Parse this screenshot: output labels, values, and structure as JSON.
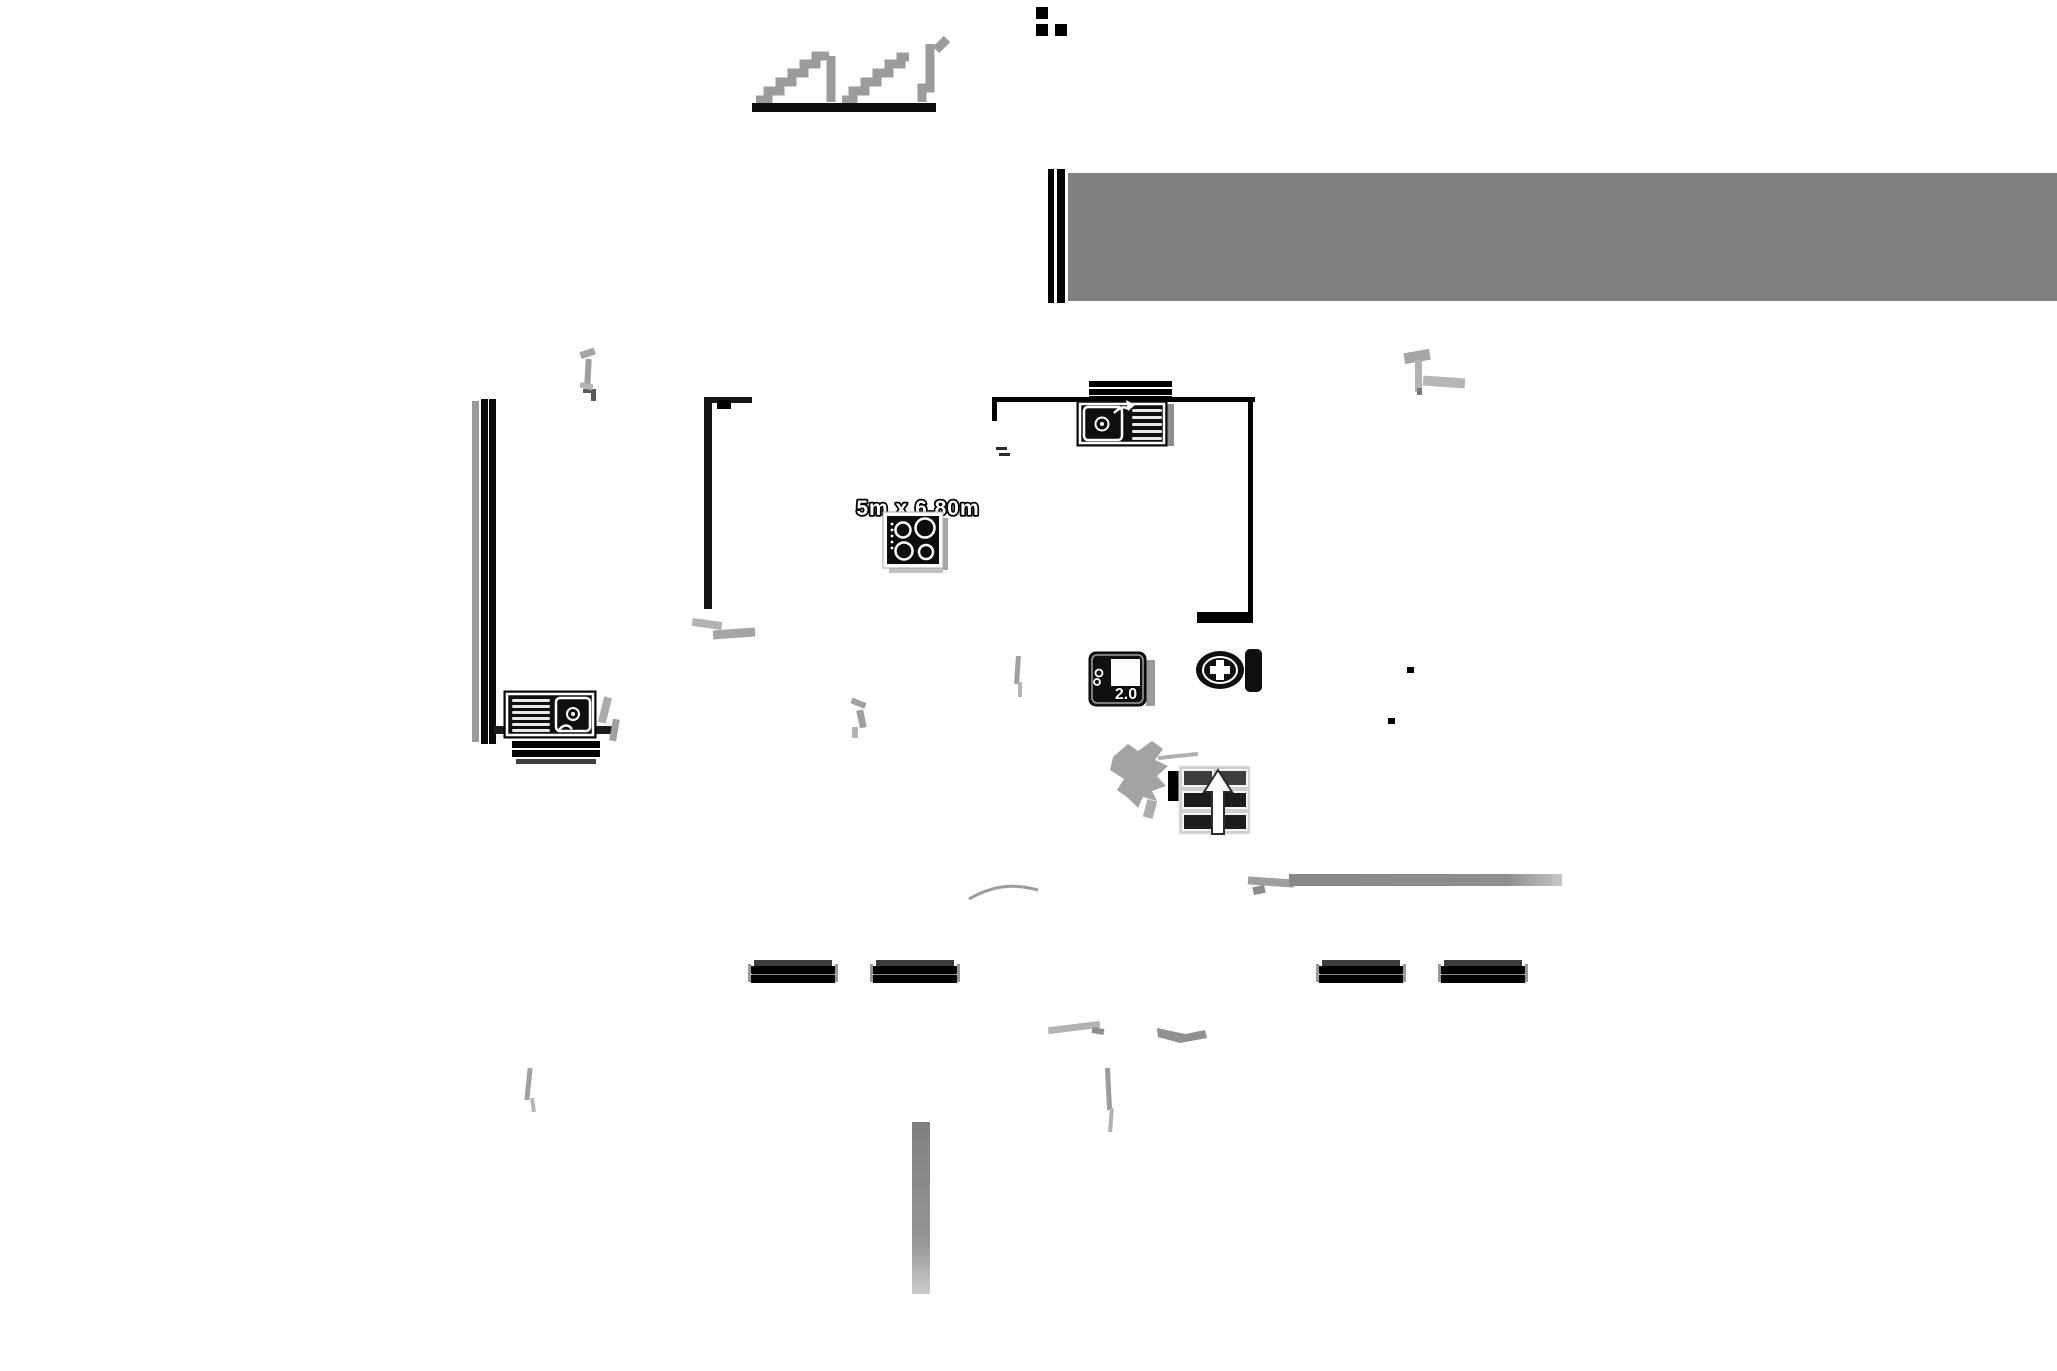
{
  "app": {
    "type": "floor-plan-drawing",
    "background": "#ffffff",
    "width_px": 2057,
    "height_px": 1371
  },
  "labels": {
    "room_dimension": "5m x 6.80m",
    "door_width": "2.0"
  },
  "colors": {
    "banner_gray": "#7f7f7f",
    "wall_black": "#0a0a0a",
    "fixture_black": "#0f0f0f",
    "step_gray": "#9b9b9b",
    "faint_gray": "#b3b3b3",
    "fixture_outline_white": "#ffffff"
  },
  "symbols": {
    "stair_profile_glyph": "stepped sawtooth profile over black baseline",
    "menu_dots_glyph": "three black squares (L-shaped cluster)",
    "banner_bar": "gray banner with double black edge bars",
    "exterior_wall_left": "triple-stripe wall (gray + two black)",
    "kitchen_sink_left": "sink with drainboard, drain and faucet",
    "kitchen_sink_top": "sink with basin left, drainboard right",
    "window_top": "three stacked black bars",
    "stove_cooktop": "four-burner cooktop with control dots",
    "door_symbol": "black rounded panel with hinges, white leaf",
    "toilet": "oval bowl with cross, rectangular tank",
    "cabinet_grid_with_arrow": "3x2 dark cell grid with white up arrow",
    "stair_smudge": "gray stepped blob",
    "step_bars": "four striped black bars",
    "door_swing_arc": "thin gray arc"
  }
}
